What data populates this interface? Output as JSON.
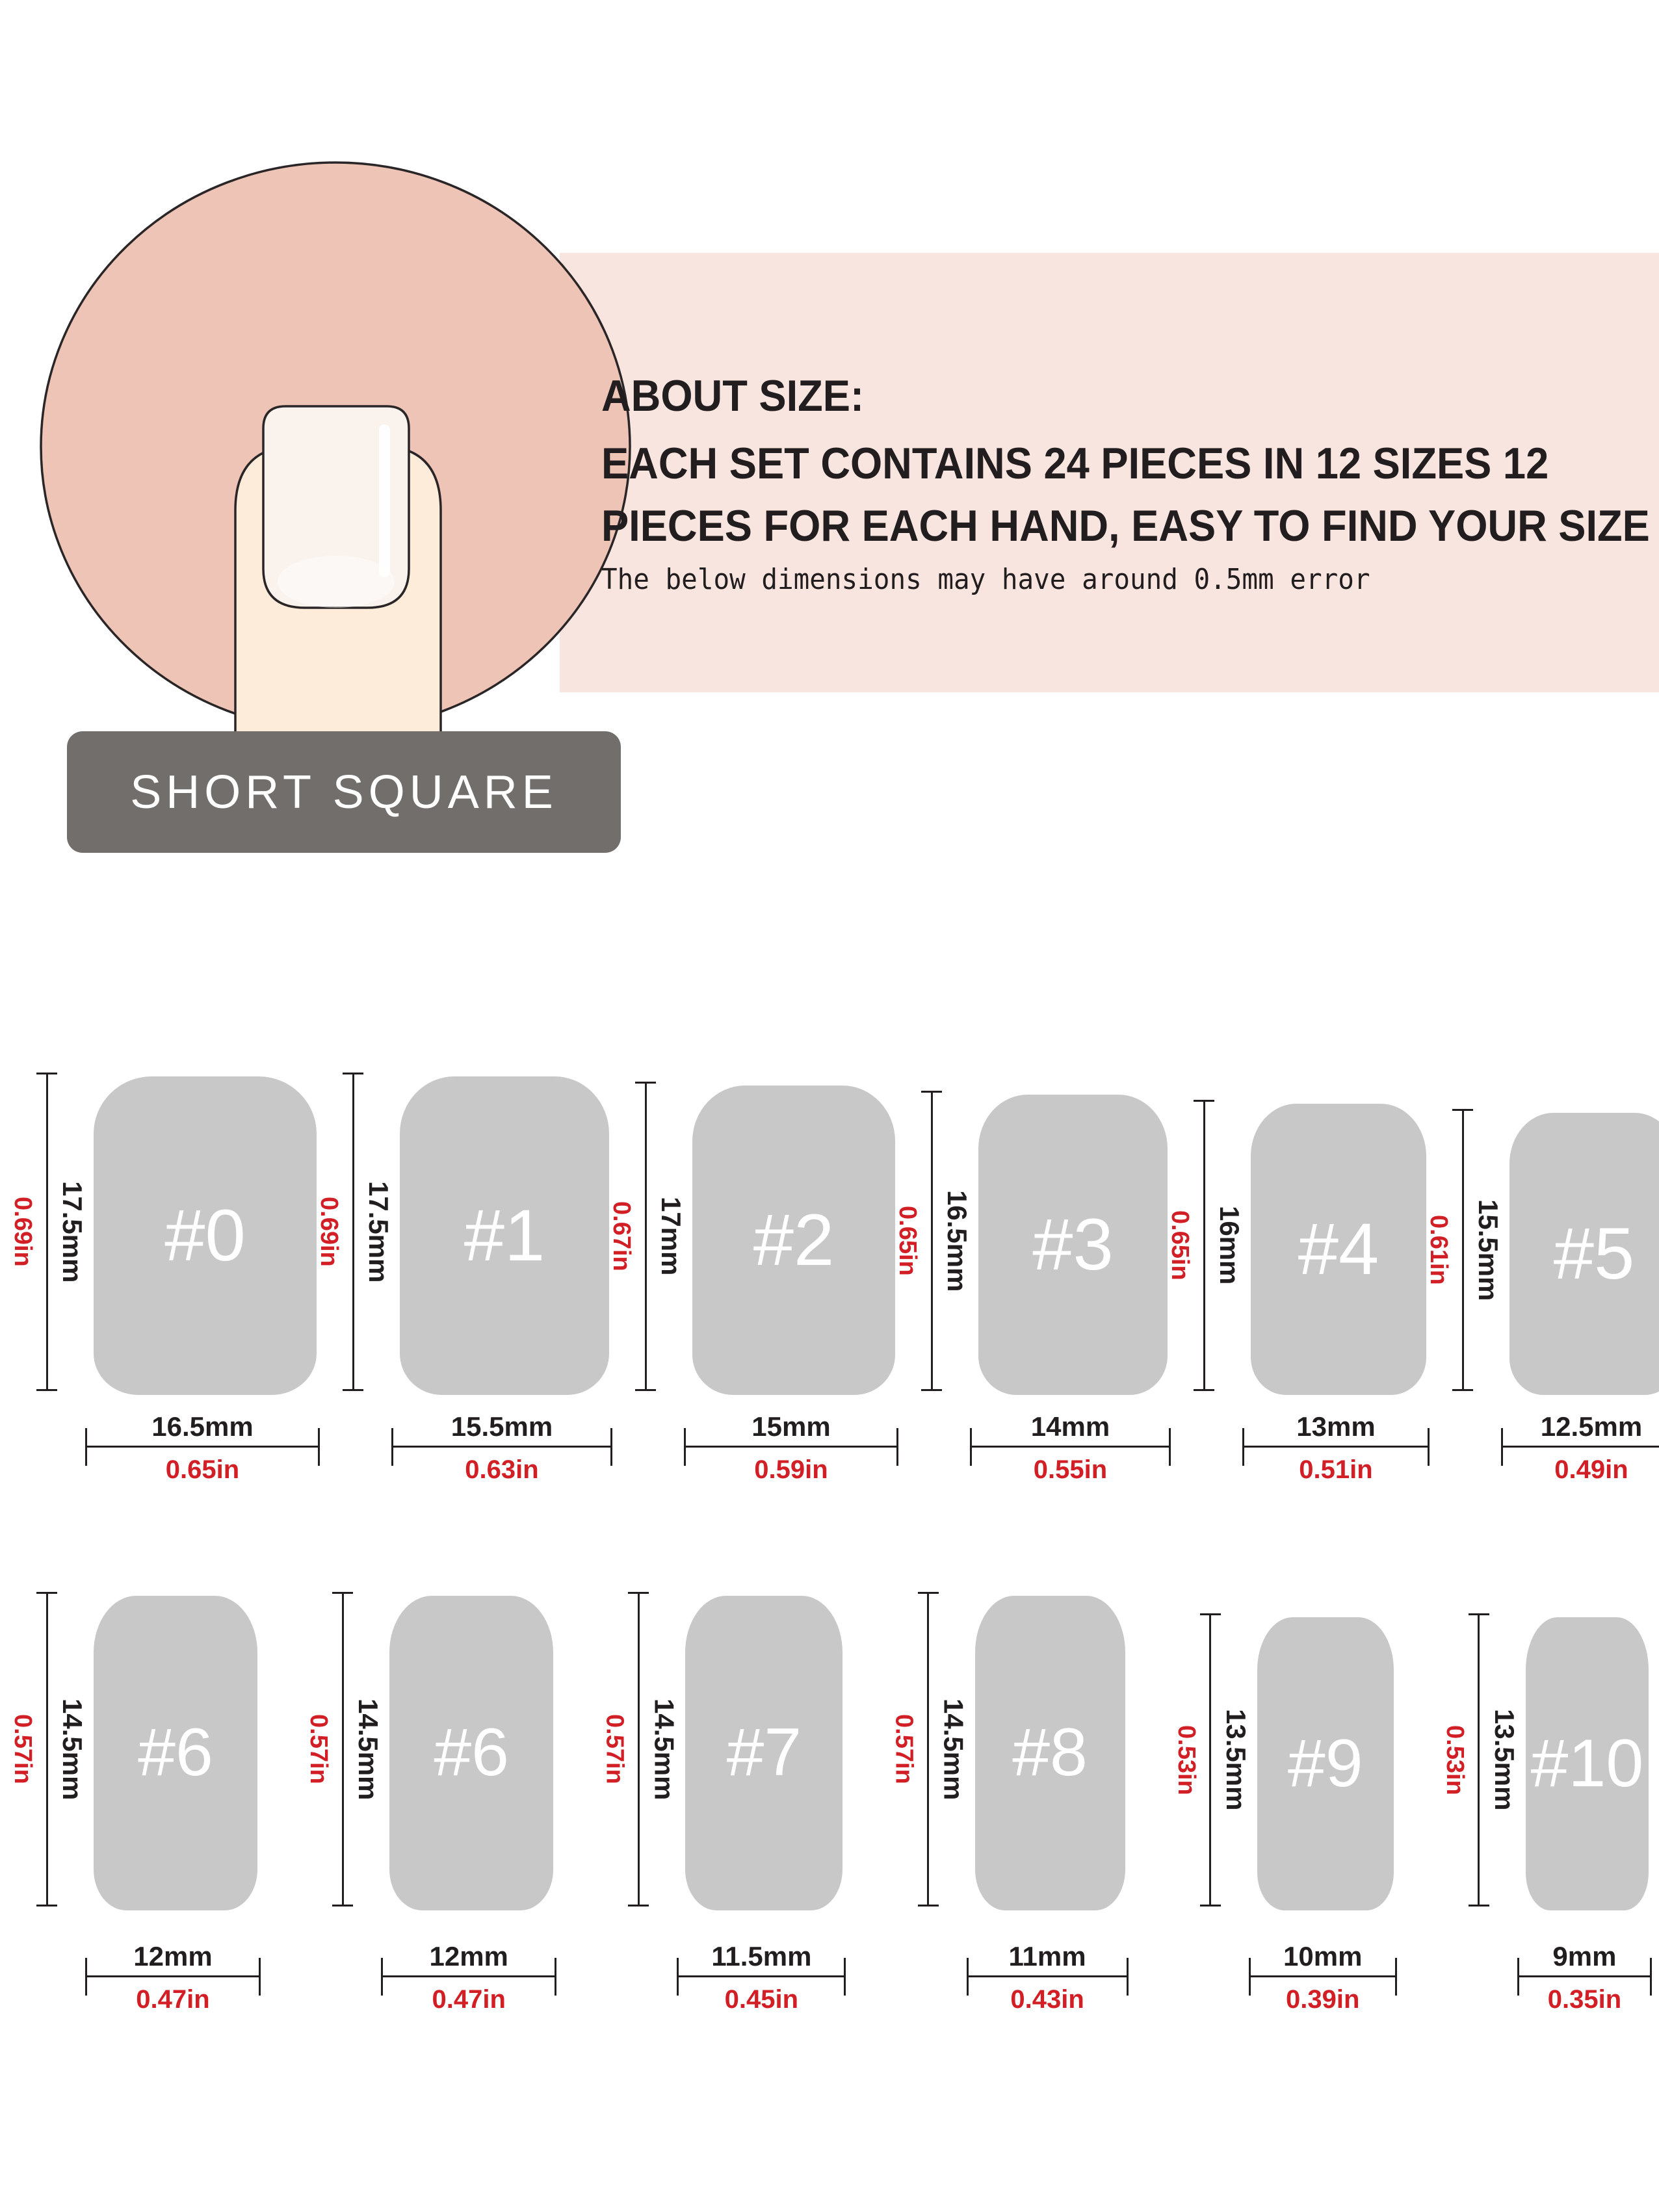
{
  "header": {
    "shape_label": "SHORT SQUARE",
    "about": {
      "title": "ABOUT SIZE:",
      "line1": "EACH SET CONTAINS 24 PIECES IN 12 SIZES 12",
      "line2": "PIECES FOR EACH HAND, EASY TO FIND YOUR SIZE",
      "note": "The below dimensions may have around 0.5mm error"
    }
  },
  "colors": {
    "accent_red": "#d21f26",
    "text_dark": "#221e1f",
    "circle_fill": "#edc4b5",
    "banner_fill": "#f9e5df",
    "finger_fill": "#fcecd9",
    "nail_plate_fill": "#faf3ed",
    "shape_label_bg": "#716e6c",
    "shape_label_text": "#ffffff",
    "nail_gray": "#c8c8c8",
    "nail_number_text": "#ffffff"
  },
  "size_chart": {
    "rows": [
      {
        "nails": [
          {
            "label": "#0",
            "height_mm": 17.5,
            "width_mm": 16.5,
            "height_mm_label": "17.5mm",
            "height_in_label": "0.69in",
            "width_mm_label": "16.5mm",
            "width_in_label": "0.65in"
          },
          {
            "label": "#1",
            "height_mm": 17.5,
            "width_mm": 15.5,
            "height_mm_label": "17.5mm",
            "height_in_label": "0.69in",
            "width_mm_label": "15.5mm",
            "width_in_label": "0.63in"
          },
          {
            "label": "#2",
            "height_mm": 17,
            "width_mm": 15,
            "height_mm_label": "17mm",
            "height_in_label": "0.67in",
            "width_mm_label": "15mm",
            "width_in_label": "0.59in"
          },
          {
            "label": "#3",
            "height_mm": 16.5,
            "width_mm": 14,
            "height_mm_label": "16.5mm",
            "height_in_label": "0.65in",
            "width_mm_label": "14mm",
            "width_in_label": "0.55in"
          },
          {
            "label": "#4",
            "height_mm": 16,
            "width_mm": 13,
            "height_mm_label": "16mm",
            "height_in_label": "0.65in",
            "width_mm_label": "13mm",
            "width_in_label": "0.51in"
          },
          {
            "label": "#5",
            "height_mm": 15.5,
            "width_mm": 12.5,
            "height_mm_label": "15.5mm",
            "height_in_label": "0.61in",
            "width_mm_label": "12.5mm",
            "width_in_label": "0.49in"
          }
        ]
      },
      {
        "nails": [
          {
            "label": "#6",
            "height_mm": 14.5,
            "width_mm": 12,
            "height_mm_label": "14.5mm",
            "height_in_label": "0.57in",
            "width_mm_label": "12mm",
            "width_in_label": "0.47in"
          },
          {
            "label": "#6",
            "height_mm": 14.5,
            "width_mm": 12,
            "height_mm_label": "14.5mm",
            "height_in_label": "0.57in",
            "width_mm_label": "12mm",
            "width_in_label": "0.47in"
          },
          {
            "label": "#7",
            "height_mm": 14.5,
            "width_mm": 11.5,
            "height_mm_label": "14.5mm",
            "height_in_label": "0.57in",
            "width_mm_label": "11.5mm",
            "width_in_label": "0.45in"
          },
          {
            "label": "#8",
            "height_mm": 14.5,
            "width_mm": 11,
            "height_mm_label": "14.5mm",
            "height_in_label": "0.57in",
            "width_mm_label": "11mm",
            "width_in_label": "0.43in"
          },
          {
            "label": "#9",
            "height_mm": 13.5,
            "width_mm": 10,
            "height_mm_label": "13.5mm",
            "height_in_label": "0.53in",
            "width_mm_label": "10mm",
            "width_in_label": "0.39in"
          },
          {
            "label": "#10",
            "height_mm": 13.5,
            "width_mm": 9,
            "height_mm_label": "13.5mm",
            "height_in_label": "0.53in",
            "width_mm_label": "9mm",
            "width_in_label": "0.35in"
          }
        ]
      }
    ]
  }
}
